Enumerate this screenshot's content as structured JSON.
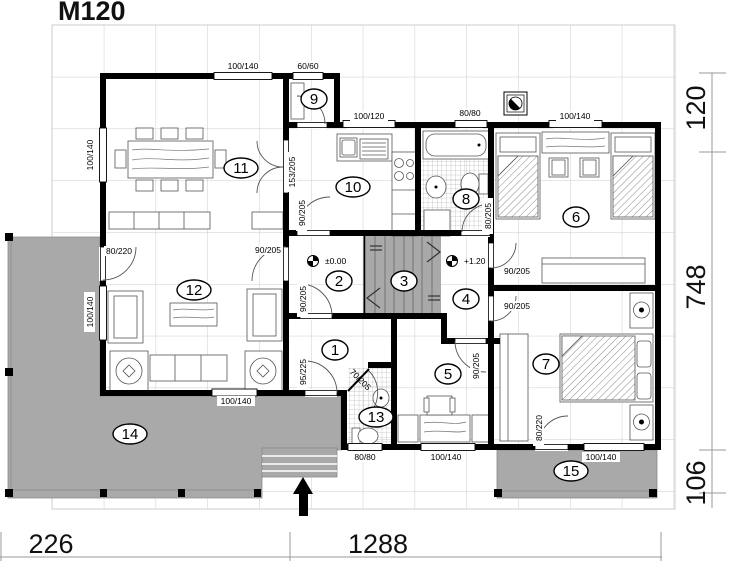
{
  "title": "M120",
  "rooms": [
    "1",
    "2",
    "3",
    "4",
    "5",
    "6",
    "7",
    "8",
    "9",
    "10",
    "11",
    "12",
    "13",
    "14",
    "15"
  ],
  "levels": {
    "ground": "±0.00",
    "upper": "+1.20"
  },
  "dimensions": {
    "bottom": [
      "226",
      "1288"
    ],
    "right": [
      "120",
      "748",
      "106"
    ]
  },
  "openings": {
    "top_window_1": "100/140",
    "top_window_2": "60/60",
    "kitchen_window": "100/120",
    "bath_window": "80/80",
    "bedroom6_window": "100/140",
    "left_window_1": "100/140",
    "left_window_2": "100/140",
    "living_terrace_door": "80/220",
    "living_bottom_window": "100/140",
    "dining_double_door": "153/205",
    "kitchen_door": "90/205",
    "living_door": "90/205",
    "hall_door": "90/205",
    "entrance_door": "95/225",
    "wc_door": "70/205",
    "room5_door": "90/205",
    "bedroom6_door": "90/205",
    "bedroom7_door": "90/205",
    "bath_door": "80/205",
    "wc_window": "80/80",
    "room5_window": "100/140",
    "bedroom7_terrace_door": "80/220",
    "bedroom7_window": "100/140"
  },
  "colors": {
    "wall": "#000000",
    "terrace": "#a9a9a9",
    "grid": "#cccccc",
    "dimension_line": "#999999"
  }
}
